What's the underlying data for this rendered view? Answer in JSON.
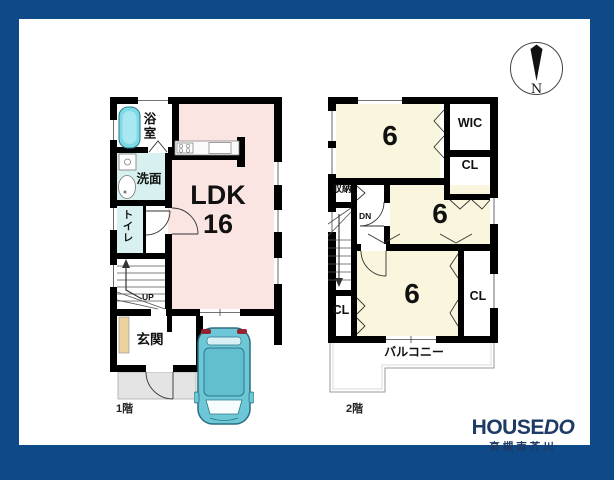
{
  "compass": {
    "north_label": "N"
  },
  "floor1": {
    "floor_label": "1階",
    "ldk": {
      "name": "LDK",
      "size": "16"
    },
    "bathroom_label": "浴室",
    "washroom_label": "洗面",
    "toilet_label": "トイレ",
    "stairs_label": "UP",
    "entrance_label": "玄関"
  },
  "floor2": {
    "floor_label": "2階",
    "bedroom1_size": "6",
    "bedroom2_size": "6",
    "bedroom3_size": "6",
    "wic_label": "WIC",
    "closet_top_label": "CL",
    "closet_left_label": "CL",
    "closet_right_label": "CL",
    "storage_label": "収納",
    "stairs_label": "DN",
    "balcony_label": "バルコニー"
  },
  "branding": {
    "brand_main": "HOUSE",
    "brand_accent": "DO",
    "branch_name": "高槻南芥川"
  },
  "colors": {
    "frame_navy": "#0e4a87",
    "ldk_floor": "#fbe5e3",
    "bedroom_floor": "#faf6dd",
    "wet_area_floor": "#d8f1f0",
    "bathtub": "#7edbe6",
    "car_body": "#6ec7d6",
    "entrance_cabinet": "#ecd29c",
    "porch_gray": "#e4e4e4",
    "wall": "#000000",
    "logo_navy": "#1e3a66"
  }
}
